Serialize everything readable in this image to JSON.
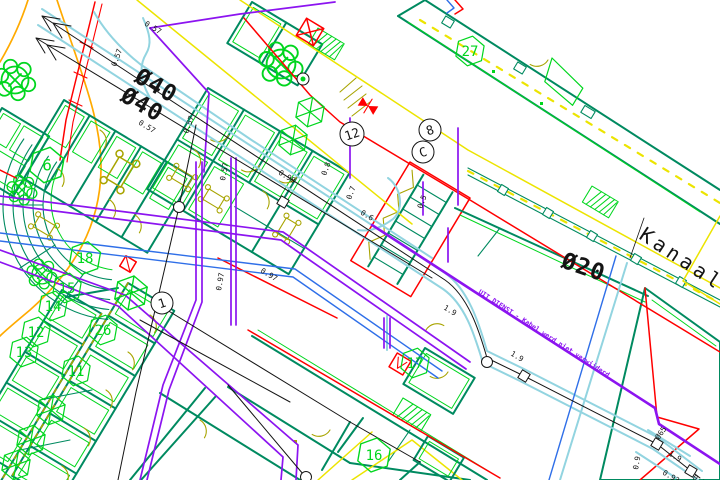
{
  "drawing": {
    "kind": "cad-utility-plan",
    "labels": {
      "dia40_a": "Ø40",
      "dia40_b": "Ø40",
      "dia20": "Ø20",
      "kanaal": "Kanaal 90",
      "uit_dienst": "UIT DIENST - Kabel werd niet verwijderd"
    },
    "dims": [
      "0.57",
      "0.57",
      "0.57",
      "0.57",
      "0.98",
      "0.8",
      "0.7",
      "0.6",
      "0.5",
      "0.97",
      "0.97",
      "0.57",
      "1.9",
      "1.9",
      "1.9",
      "Ø65",
      "0.9",
      "0.93",
      "0.91"
    ],
    "rooms": [
      "6",
      "18",
      "15",
      "14",
      "12",
      "13",
      "11",
      "26",
      "27",
      "17",
      "16"
    ],
    "nodes": [
      "12",
      "8",
      "C",
      "1"
    ]
  },
  "palette": {
    "paper": "#ffffff",
    "ink": "#141414",
    "teal": "#008a60",
    "green": "#00d61e",
    "red": "#ff0000",
    "cyan": "#92d4e0",
    "purple": "#8c14f0",
    "blue": "#2f6fe8",
    "yellow": "#ece400",
    "olive": "#a8a400",
    "orange": "#ffaa00"
  }
}
